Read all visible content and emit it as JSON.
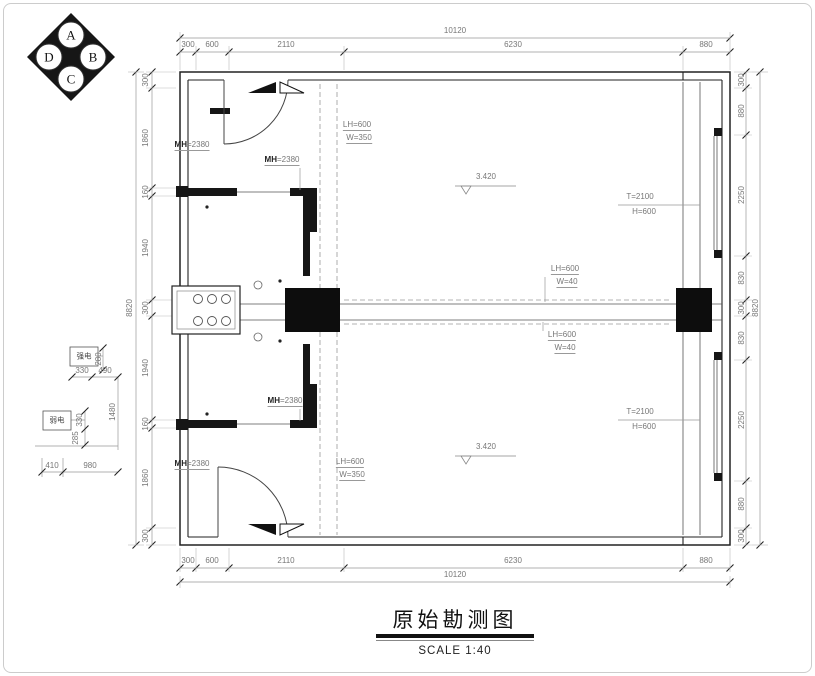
{
  "meta": {
    "title": "原始勘测图",
    "scale_label": "SCALE 1:40"
  },
  "dimension_chains": {
    "top": {
      "overall": "10120",
      "segments": [
        "300",
        "600",
        "2110",
        "6230",
        "880"
      ]
    },
    "bottom": {
      "overall": "10120",
      "segments": [
        "300",
        "600",
        "2110",
        "6230",
        "880"
      ]
    },
    "left": {
      "overall": "8820",
      "segments": [
        "300",
        "1860",
        "160",
        "1940",
        "300",
        "1940",
        "160",
        "1860",
        "300"
      ]
    },
    "right": {
      "overall": "8820",
      "segments": [
        "300",
        "880",
        "2250",
        "830",
        "300",
        "830",
        "2250",
        "880",
        "300"
      ]
    },
    "utility": [
      "280",
      "330",
      "490",
      "1480",
      "330",
      "285",
      "410",
      "980"
    ]
  },
  "compass": {
    "letters": [
      "A",
      "B",
      "C",
      "D"
    ]
  },
  "annotations": {
    "door_height": "MH=2380",
    "beam_top": [
      "LH=600",
      "W=350"
    ],
    "beam_mid": [
      "LH=600",
      "W=40"
    ],
    "window": [
      "T=2100",
      "H=600"
    ],
    "level": "3.420",
    "strong_current_box": "强电",
    "weak_current_box": "弱电"
  },
  "labels": [
    {
      "t": "10120",
      "x": 455,
      "y": 31
    },
    {
      "t": "300",
      "x": 188,
      "y": 45
    },
    {
      "t": "600",
      "x": 212,
      "y": 45
    },
    {
      "t": "2110",
      "x": 286,
      "y": 45
    },
    {
      "t": "6230",
      "x": 513,
      "y": 45
    },
    {
      "t": "880",
      "x": 706,
      "y": 45
    },
    {
      "t": "300",
      "x": 188,
      "y": 561
    },
    {
      "t": "600",
      "x": 212,
      "y": 561
    },
    {
      "t": "2110",
      "x": 286,
      "y": 561
    },
    {
      "t": "6230",
      "x": 513,
      "y": 561
    },
    {
      "t": "880",
      "x": 706,
      "y": 561
    },
    {
      "t": "10120",
      "x": 455,
      "y": 575
    },
    {
      "t": "300",
      "x": 146,
      "y": 80,
      "r": -90
    },
    {
      "t": "1860",
      "x": 146,
      "y": 138,
      "r": -90
    },
    {
      "t": "160",
      "x": 146,
      "y": 192,
      "r": -90
    },
    {
      "t": "1940",
      "x": 146,
      "y": 248,
      "r": -90
    },
    {
      "t": "300",
      "x": 146,
      "y": 308,
      "r": -90
    },
    {
      "t": "1940",
      "x": 146,
      "y": 368,
      "r": -90
    },
    {
      "t": "160",
      "x": 146,
      "y": 424,
      "r": -90
    },
    {
      "t": "1860",
      "x": 146,
      "y": 478,
      "r": -90
    },
    {
      "t": "300",
      "x": 146,
      "y": 536,
      "r": -90
    },
    {
      "t": "8820",
      "x": 130,
      "y": 308,
      "r": -90
    },
    {
      "t": "300",
      "x": 742,
      "y": 80,
      "r": -90
    },
    {
      "t": "880",
      "x": 742,
      "y": 111,
      "r": -90
    },
    {
      "t": "2250",
      "x": 742,
      "y": 195,
      "r": -90
    },
    {
      "t": "830",
      "x": 742,
      "y": 278,
      "r": -90
    },
    {
      "t": "300",
      "x": 742,
      "y": 308,
      "r": -90
    },
    {
      "t": "830",
      "x": 742,
      "y": 338,
      "r": -90
    },
    {
      "t": "2250",
      "x": 742,
      "y": 420,
      "r": -90
    },
    {
      "t": "880",
      "x": 742,
      "y": 504,
      "r": -90
    },
    {
      "t": "300",
      "x": 742,
      "y": 536,
      "r": -90
    },
    {
      "t": "8820",
      "x": 756,
      "y": 308,
      "r": -90
    },
    {
      "t": "280",
      "x": 99,
      "y": 359,
      "r": -90
    },
    {
      "t": "330",
      "x": 82,
      "y": 371
    },
    {
      "t": "490",
      "x": 105,
      "y": 371
    },
    {
      "t": "1480",
      "x": 113,
      "y": 412,
      "r": -90
    },
    {
      "t": "330",
      "x": 80,
      "y": 420,
      "r": -90
    },
    {
      "t": "285",
      "x": 76,
      "y": 438,
      "r": -90
    },
    {
      "t": "410",
      "x": 52,
      "y": 466
    },
    {
      "t": "980",
      "x": 90,
      "y": 466
    },
    {
      "t": "强电",
      "x": 84,
      "y": 356,
      "c": "cn",
      "n": "strong-current-label"
    },
    {
      "t": "弱电",
      "x": 57,
      "y": 420,
      "c": "cn",
      "n": "weak-current-label"
    },
    {
      "t": "MH=2380",
      "x": 192,
      "y": 146,
      "c": "u",
      "sp": "MH",
      "n": "door-height-label"
    },
    {
      "t": "MH=2380",
      "x": 282,
      "y": 161,
      "c": "u",
      "sp": "MH",
      "n": "door-height-label"
    },
    {
      "t": "MH=2380",
      "x": 285,
      "y": 402,
      "c": "u",
      "sp": "MH",
      "n": "door-height-label"
    },
    {
      "t": "MH=2380",
      "x": 192,
      "y": 465,
      "c": "u",
      "sp": "MH",
      "n": "door-height-label"
    },
    {
      "t": "LH=600",
      "x": 357,
      "y": 126,
      "c": "u",
      "n": "beam-label"
    },
    {
      "t": "W=350",
      "x": 359,
      "y": 139,
      "c": "u",
      "n": "beam-label"
    },
    {
      "t": "LH=600",
      "x": 350,
      "y": 463,
      "c": "u",
      "n": "beam-label"
    },
    {
      "t": "W=350",
      "x": 352,
      "y": 476,
      "c": "u",
      "n": "beam-label"
    },
    {
      "t": "LH=600",
      "x": 565,
      "y": 270,
      "c": "u",
      "n": "beam-label"
    },
    {
      "t": "W=40",
      "x": 567,
      "y": 283,
      "c": "u",
      "n": "beam-label"
    },
    {
      "t": "LH=600",
      "x": 562,
      "y": 336,
      "c": "u",
      "n": "beam-label"
    },
    {
      "t": "W=40",
      "x": 565,
      "y": 349,
      "c": "u",
      "n": "beam-label"
    },
    {
      "t": "T=2100",
      "x": 640,
      "y": 197,
      "n": "window-label"
    },
    {
      "t": "H=600",
      "x": 644,
      "y": 212,
      "n": "window-label"
    },
    {
      "t": "T=2100",
      "x": 640,
      "y": 412,
      "n": "window-label"
    },
    {
      "t": "H=600",
      "x": 644,
      "y": 427,
      "n": "window-label"
    },
    {
      "t": "3.420",
      "x": 486,
      "y": 177,
      "n": "level-label"
    },
    {
      "t": "3.420",
      "x": 486,
      "y": 447,
      "n": "level-label"
    },
    {
      "t": "A",
      "x": 71,
      "y": 35,
      "c": "comp",
      "n": "compass-letter"
    },
    {
      "t": "B",
      "x": 93,
      "y": 57,
      "c": "comp",
      "n": "compass-letter"
    },
    {
      "t": "C",
      "x": 71,
      "y": 79,
      "c": "comp",
      "n": "compass-letter"
    },
    {
      "t": "D",
      "x": 49,
      "y": 57,
      "c": "comp",
      "n": "compass-letter"
    }
  ]
}
